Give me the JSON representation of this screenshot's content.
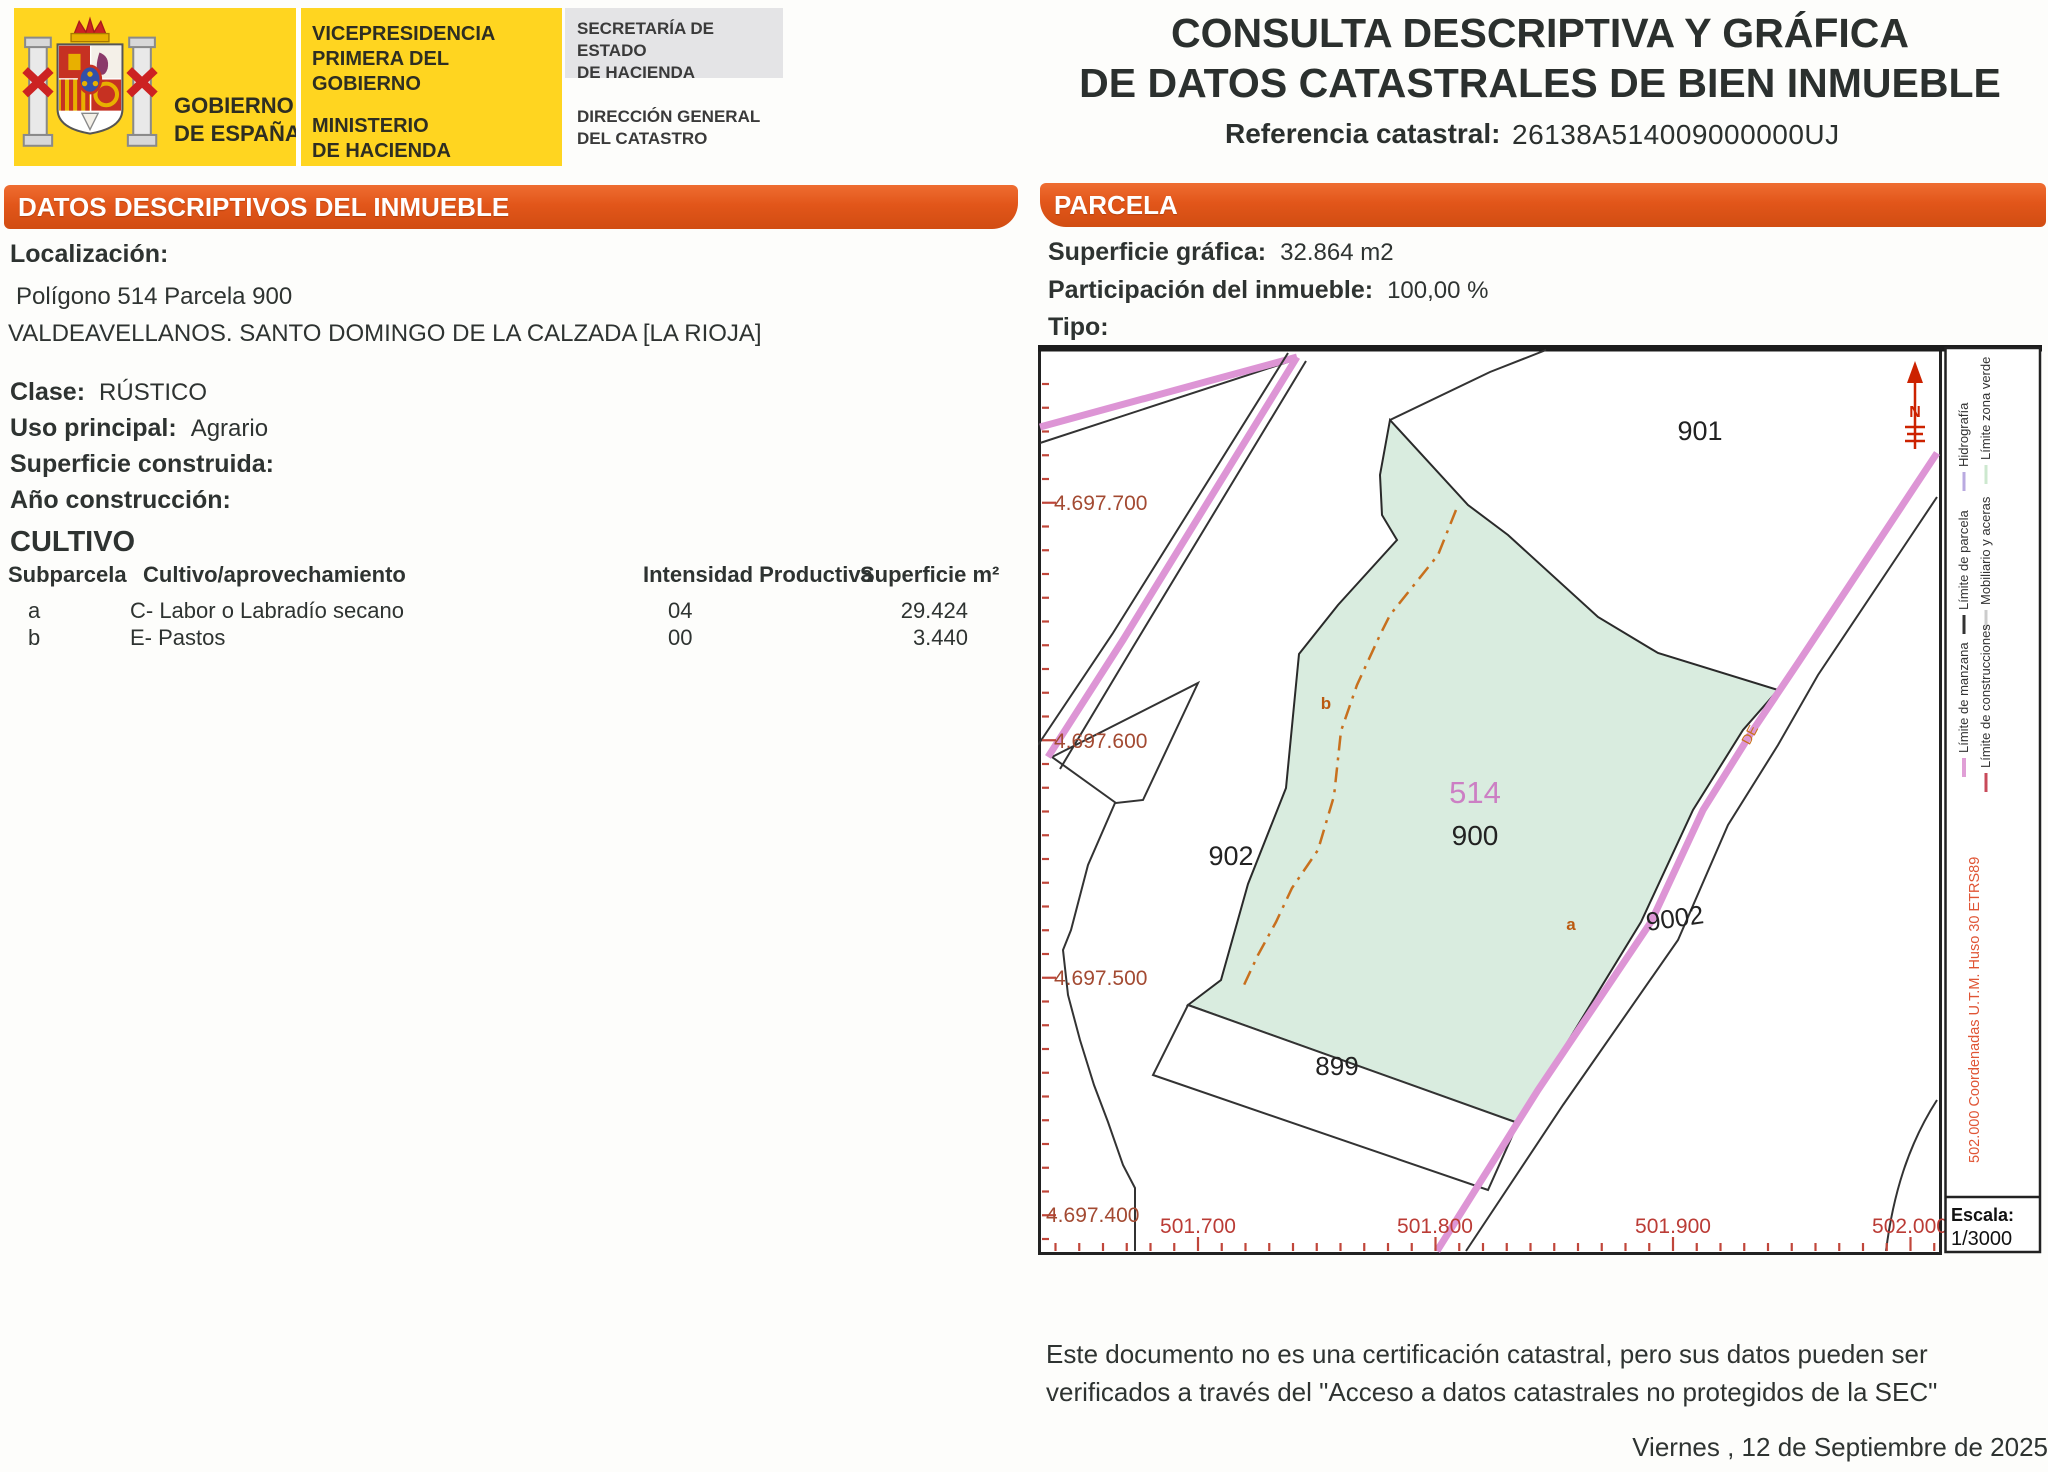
{
  "header": {
    "gobierno": "GOBIERNO\nDE ESPAÑA",
    "vicepresidencia": "VICEPRESIDENCIA\nPRIMERA DEL GOBIERNO",
    "ministerio": "MINISTERIO\nDE HACIENDA",
    "secretaria": "SECRETARÍA DE ESTADO\nDE HACIENDA",
    "direccion": "DIRECCIÓN GENERAL\nDEL CATASTRO",
    "title_line1": "CONSULTA DESCRIPTIVA Y GRÁFICA",
    "title_line2": "DE DATOS CATASTRALES DE BIEN INMUEBLE",
    "ref_label": "Referencia catastral:",
    "ref_value": "26138A514009000000UJ"
  },
  "left": {
    "section_title": "DATOS DESCRIPTIVOS DEL INMUEBLE",
    "localizacion_label": "Localización:",
    "localizacion_line1": "Polígono 514 Parcela 900",
    "localizacion_line2": "VALDEAVELLANOS. SANTO DOMINGO DE LA CALZADA [LA RIOJA]",
    "clase_label": "Clase:",
    "clase_value": "RÚSTICO",
    "uso_label": "Uso principal:",
    "uso_value": "Agrario",
    "superficie_label": "Superficie construida:",
    "superficie_value": "",
    "anio_label": "Año construcción:",
    "anio_value": "",
    "cultivo_title": "CULTIVO",
    "cultivo_headers": [
      "Subparcela",
      "Cultivo/aprovechamiento",
      "Intensidad Productiva",
      "Superficie m²"
    ],
    "cultivo_rows": [
      {
        "sub": "a",
        "cultivo": "C- Labor o Labradío secano",
        "intensidad": "04",
        "superficie": "29.424"
      },
      {
        "sub": "b",
        "cultivo": "E- Pastos",
        "intensidad": "00",
        "superficie": "3.440"
      }
    ]
  },
  "parcela": {
    "section_title": "PARCELA",
    "superficie_label": "Superficie gráfica:",
    "superficie_value": "32.864 m2",
    "participacion_label": "Participación del inmueble:",
    "participacion_value": "100,00 %",
    "tipo_label": "Tipo:",
    "tipo_value": ""
  },
  "map": {
    "labels": {
      "p901": "901",
      "p902": "902",
      "p899": "899",
      "p9002": "9002",
      "p514": "514",
      "p900": "900",
      "sub_a": "a",
      "sub_b": "b",
      "road": "DE"
    },
    "north": "N",
    "y_axis": [
      "4.697.700",
      "4.697.600",
      "4.697.500",
      "4.697.400"
    ],
    "x_axis": [
      "501.700",
      "501.800",
      "501.900",
      "502.000"
    ]
  },
  "legend": {
    "entries": [
      {
        "label": "Hidrografía",
        "color": "#b9aae0"
      },
      {
        "label": "Límite zona verde",
        "color": "#cde8cf"
      },
      {
        "label": "Límite de parcela",
        "color": "#333333"
      },
      {
        "label": "Mobiliario y aceras",
        "color": "#cccccc"
      },
      {
        "label": "Límite de manzana",
        "color": "#e09fd6"
      },
      {
        "label": "Límite de construcciones",
        "color": "#c84a5a"
      }
    ],
    "coords_note": "502.000 Coordenadas U.T.M. Huso 30 ETRS89",
    "escala_label": "Escala:",
    "escala_value": "1/3000"
  },
  "footer": {
    "disclaimer": "Este documento no es una certificación catastral, pero sus datos pueden ser verificados a través del \"Acceso a datos catastrales no protegidos de la SEC\"",
    "date": "Viernes , 12 de Septiembre de 2025"
  },
  "colors": {
    "header_yellow": "#ffd520",
    "bar_orange": "#e2561a",
    "parcel_green": "#d9ecdf",
    "road_pink": "#dd95d5",
    "axis_red": "#b04434",
    "subparcel_orange": "#c8701e"
  }
}
